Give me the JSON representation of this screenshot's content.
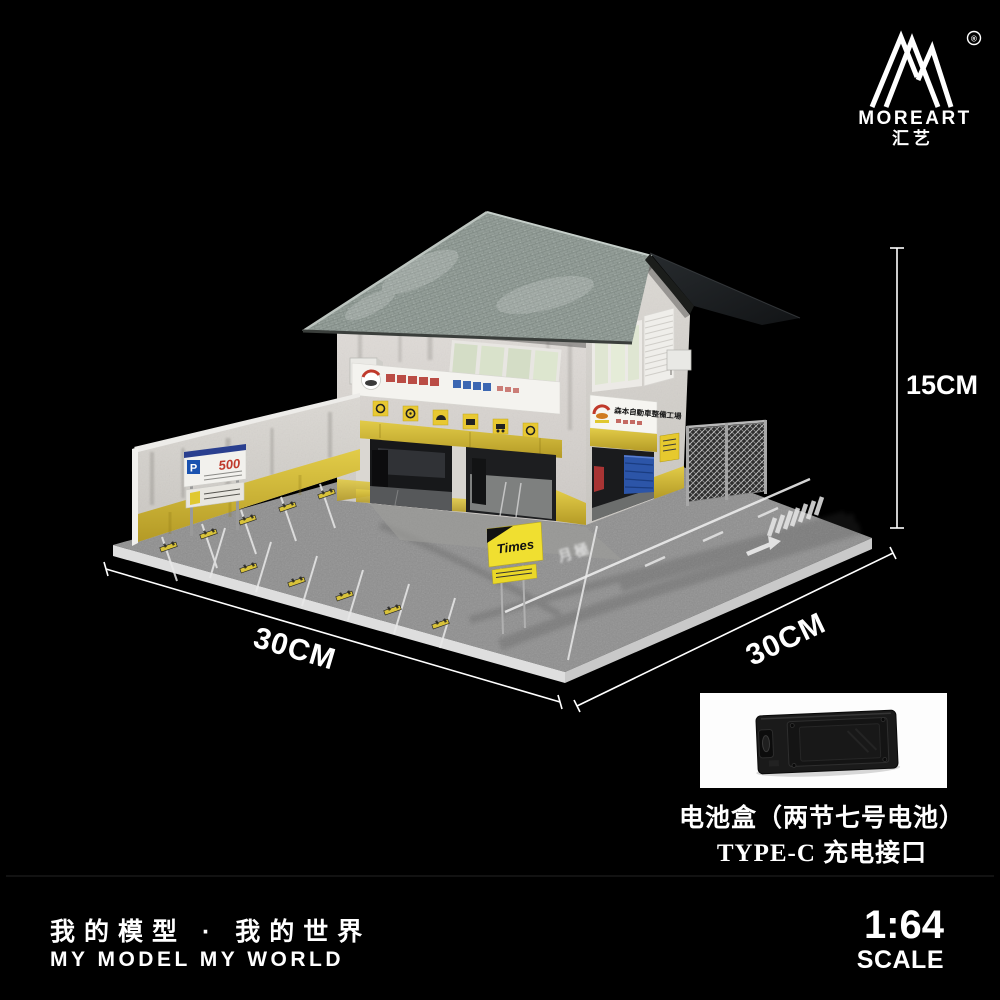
{
  "brand": {
    "name": "MOREART",
    "name_cn": "汇艺",
    "registered_mark": "®"
  },
  "dimensions": {
    "height_label": "15CM",
    "left_width_label": "30CM",
    "right_width_label": "30CM"
  },
  "diorama": {
    "garage_sign_text": "森本自動車整備工場",
    "parking_sign": {
      "letter": "P",
      "price": "500"
    },
    "times_sign_label": "Times",
    "road_marking_text": "月極"
  },
  "battery_panel": {
    "caption_line1": "电池盒（两节七号电池）",
    "caption_line2": "TYPE-C 充电接口"
  },
  "footer": {
    "slogan_cn": "我的模型 · 我的世界",
    "slogan_en": "MY MODEL MY WORLD",
    "scale_ratio": "1:64",
    "scale_word": "SCALE"
  },
  "colors": {
    "background": "#000000",
    "accent_yellow": "#d9c23a",
    "roof_gray_green": "#96a09b",
    "asphalt": "#8e8e8e",
    "wall_white": "#d9d6d1",
    "sign_blue": "#1a52b0",
    "price_red": "#c0392b",
    "cabinet_blue": "#2c55a8"
  }
}
